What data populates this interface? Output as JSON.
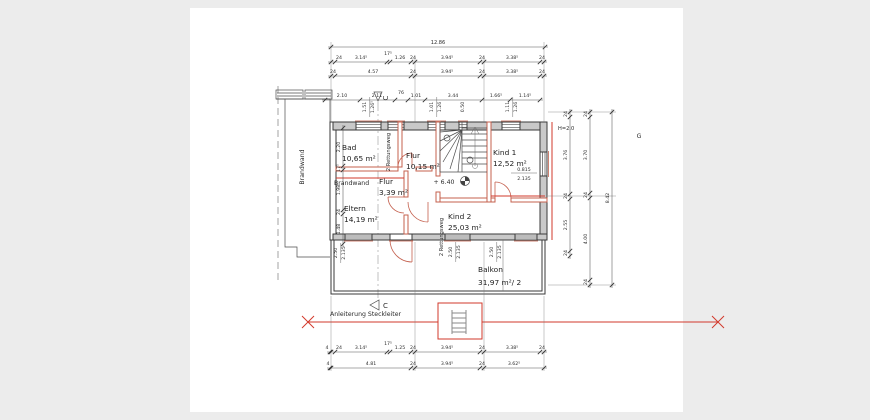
{
  "rooms": [
    {
      "name": "Bad",
      "area": "10,65 m²"
    },
    {
      "name": "Flur",
      "area": "10,15 m²"
    },
    {
      "name": "Flur",
      "area": "3,39 m²"
    },
    {
      "name": "Eltern",
      "area": "14,19 m²"
    },
    {
      "name": "Kind 1",
      "area": "12,52 m²"
    },
    {
      "name": "Kind 2",
      "area": "25,03 m²"
    },
    {
      "name": "Balkon",
      "area": "31,97 m²/ 2"
    }
  ],
  "annotations": {
    "brandwand_vertical": "Brandwand",
    "brandwand_inner": "Brandwand",
    "rettungsweg_top": "2 Rettungsweg",
    "rettungsweg_bottom": "2 Rettungsweg",
    "ladder_note": "Anleiterung Steckleiter",
    "level_mark": "+ 6.40",
    "height_note": "H=2.0",
    "section_label_top": "C",
    "section_label_bottom": "C",
    "axis_label_right": "G"
  },
  "dimensions": {
    "overall_width": "12.86",
    "top_row2": [
      "24",
      "3.14⁵",
      "17⁵",
      "1.26",
      "24",
      "3.94⁵",
      "24",
      "3.38⁵",
      "24"
    ],
    "top_row3": [
      "24",
      "4.57",
      "24",
      "3.94⁵",
      "24",
      "3.38⁵",
      "24"
    ],
    "top_row4": [
      "2.10",
      "2.11",
      "76",
      "1.01",
      "3.44",
      "1.66⁵",
      "1.14⁵"
    ],
    "bottom_row1": [
      "4",
      "24",
      "3.14⁵",
      "17⁵",
      "1.25",
      "24",
      "3.94⁵",
      "24",
      "3.38⁵",
      "24"
    ],
    "bottom_row2": [
      "4",
      "4.81",
      "24",
      "3.94⁵",
      "24",
      "3.62⁵"
    ],
    "right_inner": [
      "24",
      "3.76",
      "24",
      "2.55",
      "24"
    ],
    "right_mid": [
      "24",
      "3.70",
      "24",
      "4.00",
      "24"
    ],
    "right_overall": "8.42",
    "left_col": [
      "2.20",
      "17⁵",
      "1.98",
      "24",
      "1.48"
    ],
    "lintels": [
      {
        "a": "1.51",
        "b": "1.26⁵"
      },
      {
        "a": "1.01",
        "b": "1.26"
      },
      {
        "a": "0.50",
        "b": ""
      },
      {
        "a": "1.11",
        "b": "1.26"
      }
    ],
    "sills": [
      {
        "a": "2.50",
        "b": "2.135"
      },
      {
        "a": "2.50",
        "b": "2.135"
      },
      {
        "a": "2.50",
        "b": "2.135"
      }
    ],
    "kind1_sill": {
      "a": "0.815",
      "b": "2.135"
    }
  },
  "colors": {
    "background": "#ececec",
    "sheet": "#ffffff",
    "wall_fill": "#c9c9c9",
    "partition_red": "#c4604e",
    "accent_red": "#d2392b"
  }
}
